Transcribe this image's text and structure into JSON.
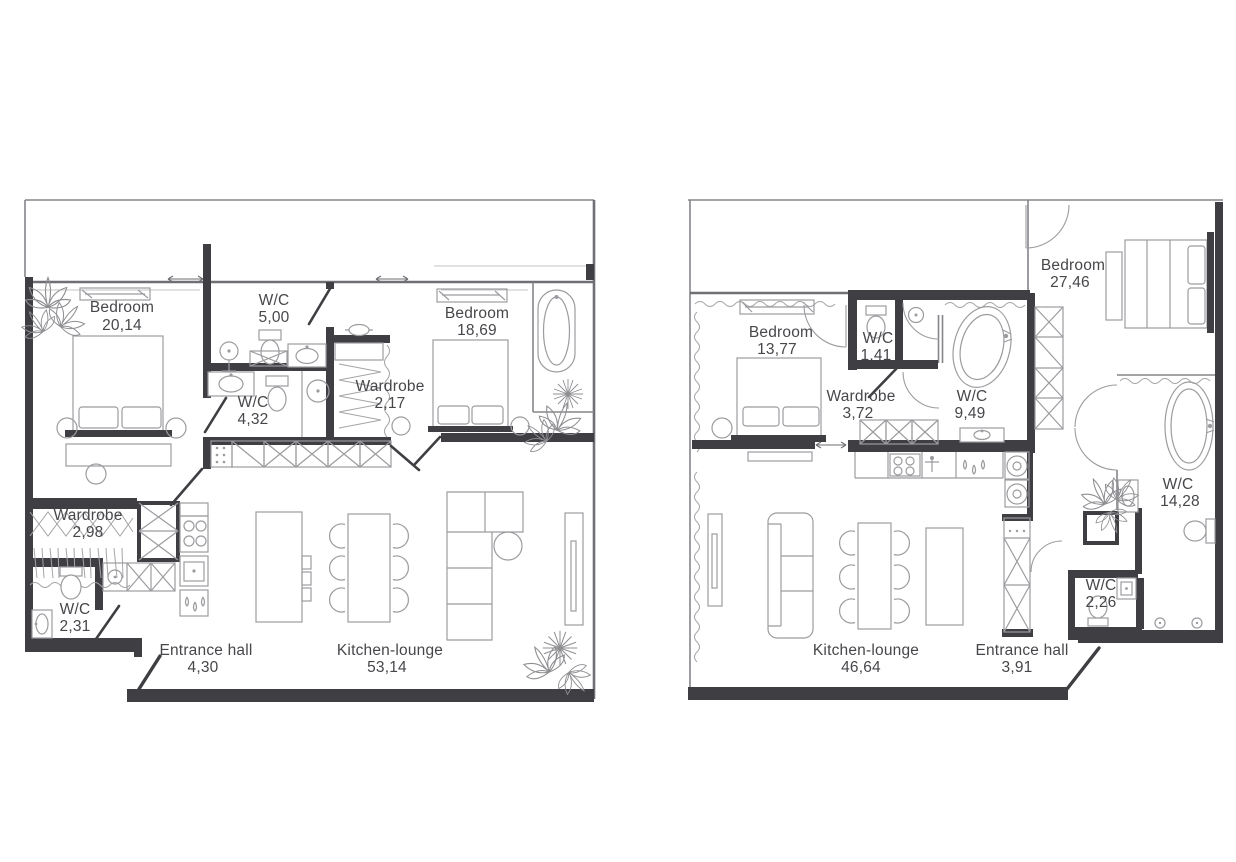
{
  "colors": {
    "background": "#ffffff",
    "wall": "#3f3f43",
    "furniture_line": "#9c9ca0",
    "thin_wall": "#85858a",
    "label_text": "#47474b"
  },
  "plans": [
    {
      "id": "left-apartment",
      "rooms": [
        {
          "name": "Bedroom",
          "area": "20,14"
        },
        {
          "name": "W/C",
          "area": "5,00"
        },
        {
          "name": "W/C",
          "area": "4,32"
        },
        {
          "name": "Wardrobe",
          "area": "2,17"
        },
        {
          "name": "Bedroom",
          "area": "18,69"
        },
        {
          "name": "Wardrobe",
          "area": "2,98"
        },
        {
          "name": "W/C",
          "area": "2,31"
        },
        {
          "name": "Entrance hall",
          "area": "4,30"
        },
        {
          "name": "Kitchen-lounge",
          "area": "53,14"
        }
      ]
    },
    {
      "id": "right-apartment",
      "rooms": [
        {
          "name": "Bedroom",
          "area": "13,77"
        },
        {
          "name": "W/C",
          "area": "1,41"
        },
        {
          "name": "Wardrobe",
          "area": "3,72"
        },
        {
          "name": "W/C",
          "area": "9,49"
        },
        {
          "name": "Bedroom",
          "area": "27,46"
        },
        {
          "name": "W/C",
          "area": "14,28"
        },
        {
          "name": "W/C",
          "area": "2,26"
        },
        {
          "name": "Kitchen-lounge",
          "area": "46,64"
        },
        {
          "name": "Entrance hall",
          "area": "3,91"
        }
      ]
    }
  ]
}
